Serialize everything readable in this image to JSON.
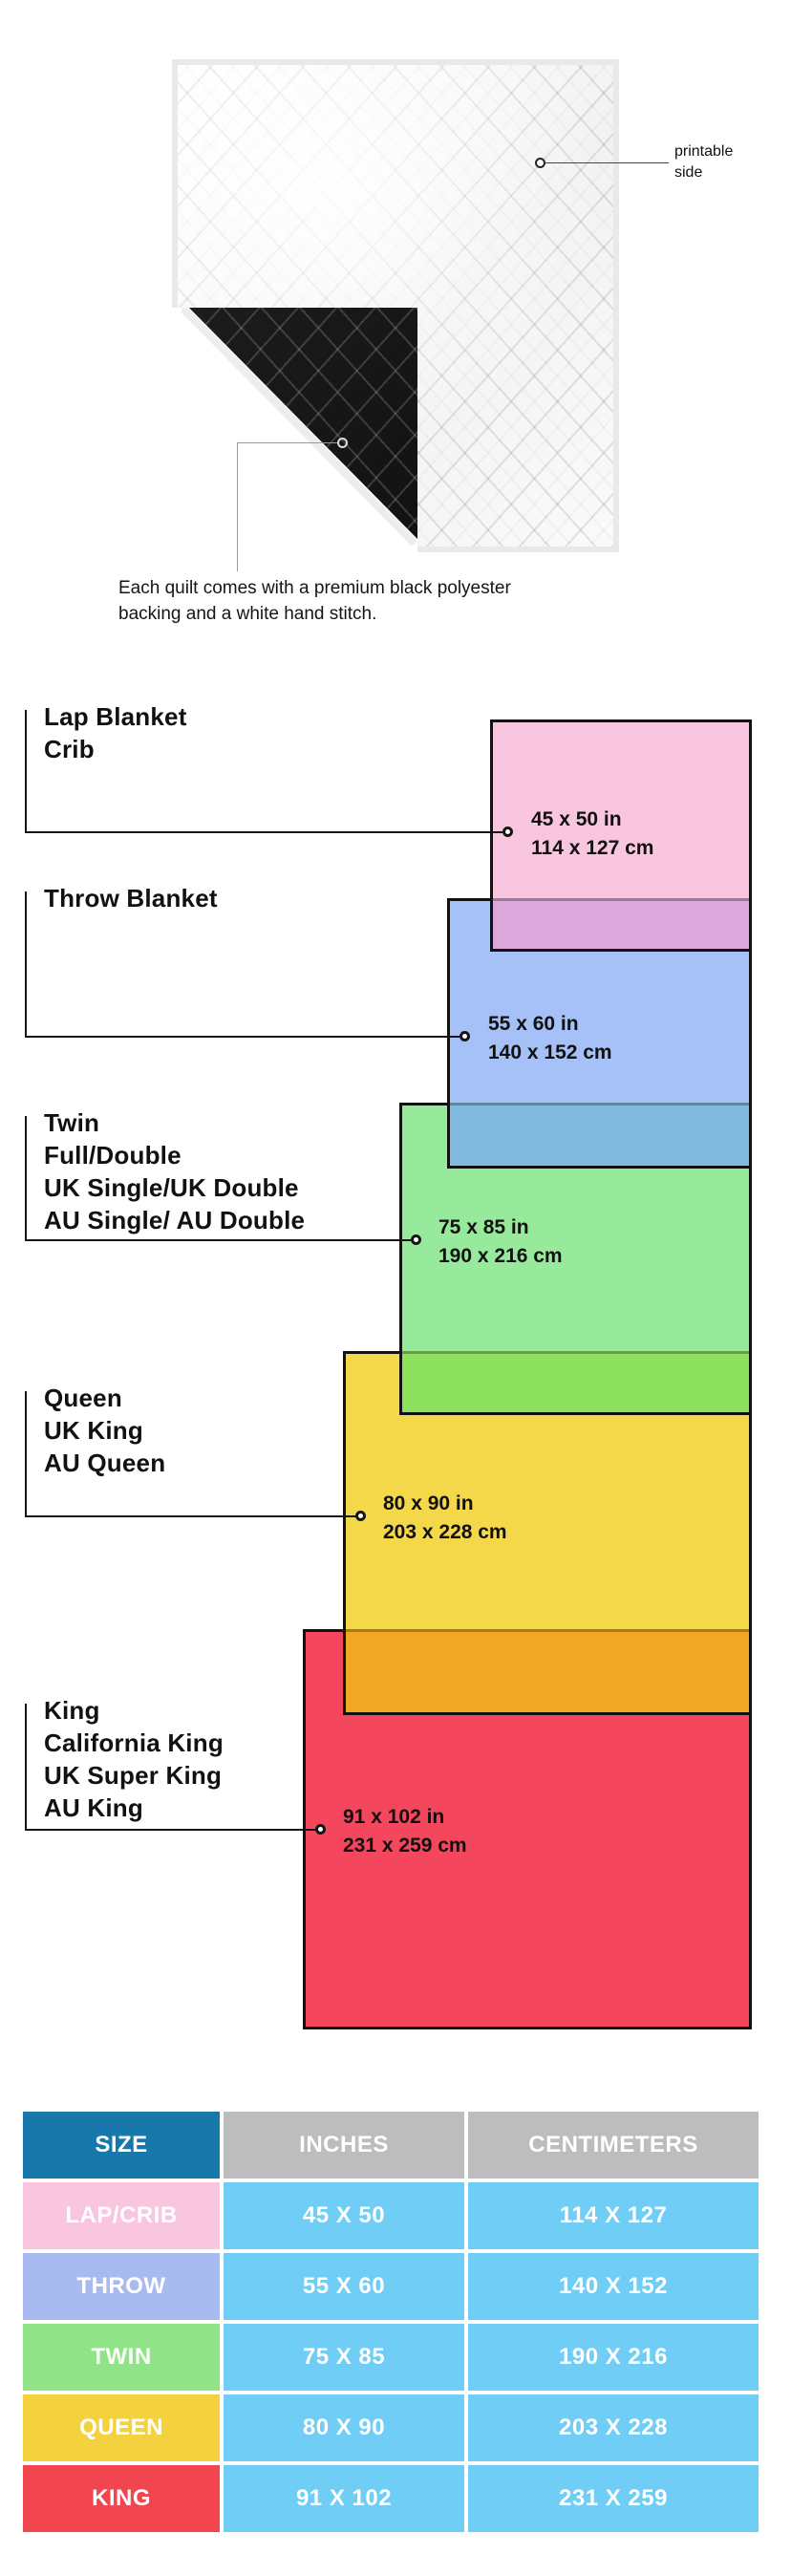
{
  "colors": {
    "pink": "#F9C6E0",
    "mauve": "#DCA8DB",
    "blue": "#A5C1F7",
    "teal": "#82BADF",
    "green": "#97EA9B",
    "green_yellow": "#8EE15E",
    "yellow": "#F5D84A",
    "orange": "#F0A724",
    "red": "#F4465C",
    "table_header_blue": "#1878AC",
    "table_header_gray": "#BDBDBD",
    "table_cell_blue": "#6FCDF6",
    "table_row_lap": "#F9C6E0",
    "table_row_throw": "#A9BAF0",
    "table_row_twin": "#90E487",
    "table_row_queen": "#F4D23F",
    "table_row_king": "#F1464F"
  },
  "hero": {
    "annotation_line1": "printable",
    "annotation_line2": "side",
    "caption_line1": "Each quilt comes with a premium black polyester",
    "caption_line2": "backing and a white hand stitch."
  },
  "diagram": {
    "sections": [
      {
        "id": "lap",
        "labels": [
          "Lap Blanket",
          "Crib"
        ],
        "inches": "45 x 50 in",
        "cm": "114 x 127 cm"
      },
      {
        "id": "throw",
        "labels": [
          "Throw Blanket"
        ],
        "inches": "55 x 60 in",
        "cm": "140 x 152 cm"
      },
      {
        "id": "twin",
        "labels": [
          "Twin",
          "Full/Double",
          "UK Single/UK Double",
          "AU Single/ AU Double"
        ],
        "inches": "75 x 85 in",
        "cm": "190 x 216 cm"
      },
      {
        "id": "queen",
        "labels": [
          "Queen",
          "UK King",
          "AU Queen"
        ],
        "inches": "80 x 90 in",
        "cm": "203 x 228 cm"
      },
      {
        "id": "king",
        "labels": [
          "King",
          "California King",
          "UK Super King",
          "AU King"
        ],
        "inches": "91 x 102 in",
        "cm": "231 x 259 cm"
      }
    ]
  },
  "table": {
    "headers": [
      "SIZE",
      "INCHES",
      "CENTIMETERS"
    ],
    "rows": [
      {
        "size": "LAP/CRIB",
        "inches": "45 X 50",
        "cm": "114 X 127"
      },
      {
        "size": "THROW",
        "inches": "55 X 60",
        "cm": "140 X 152"
      },
      {
        "size": "TWIN",
        "inches": "75 X 85",
        "cm": "190 X 216"
      },
      {
        "size": "QUEEN",
        "inches": "80 X 90",
        "cm": "203 X 228"
      },
      {
        "size": "KING",
        "inches": "91 X 102",
        "cm": "231 X 259"
      }
    ]
  }
}
